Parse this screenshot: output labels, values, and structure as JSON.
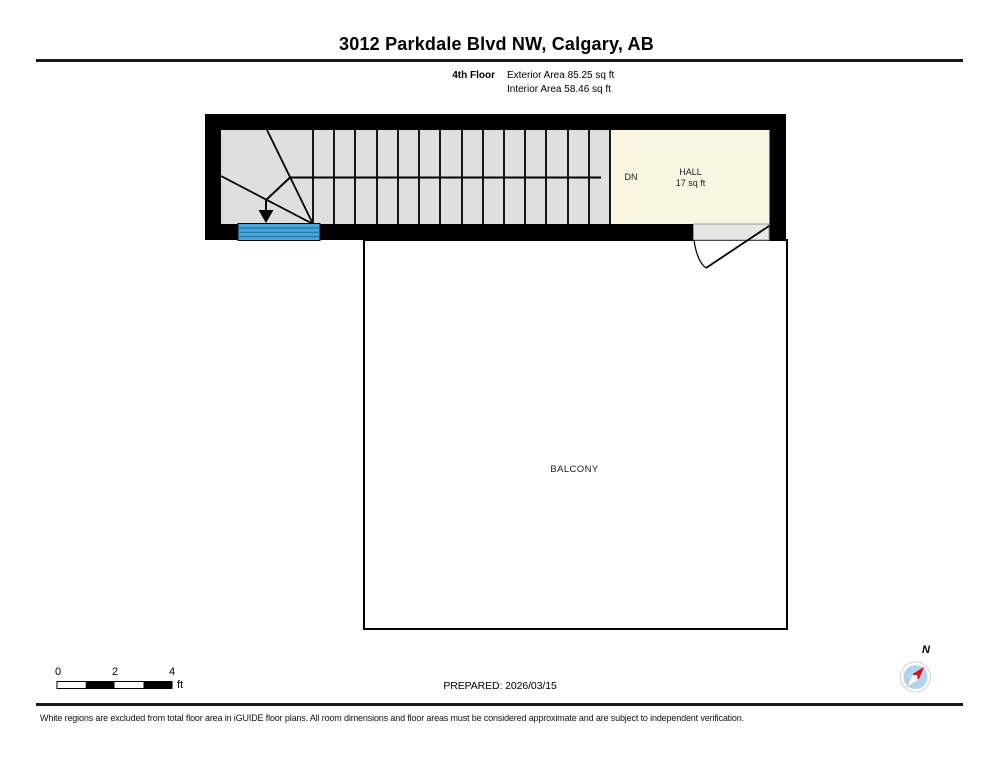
{
  "header": {
    "title": "3012 Parkdale Blvd NW, Calgary, AB",
    "floor_label": "4th Floor",
    "exterior_area": "Exterior Area 85.25 sq ft",
    "interior_area": "Interior Area 58.46 sq ft"
  },
  "plan": {
    "stairs": {
      "direction_label": "DN"
    },
    "hall": {
      "name": "HALL",
      "area": "17 sq ft"
    },
    "balcony": {
      "name": "BALCONY"
    },
    "colors": {
      "wall": "#000000",
      "stair_fill": "#dfdfdf",
      "hall_fill": "#faf5e0",
      "window_blue": "#4aa3da",
      "window_line": "#1e76ad",
      "door_fill": "#e7e7e7",
      "compass_blue": "#aed4ee",
      "compass_needle_red": "#d21515"
    }
  },
  "footer": {
    "scale_bar": {
      "ticks": [
        "0",
        "2",
        "4"
      ],
      "unit": "ft"
    },
    "prepared": "PREPARED: 2026/03/15",
    "compass": {
      "north_label": "N"
    },
    "disclaimer": "White regions are excluded from total floor area in iGUIDE floor plans. All room dimensions and floor areas must be considered approximate and are subject to independent verification."
  }
}
